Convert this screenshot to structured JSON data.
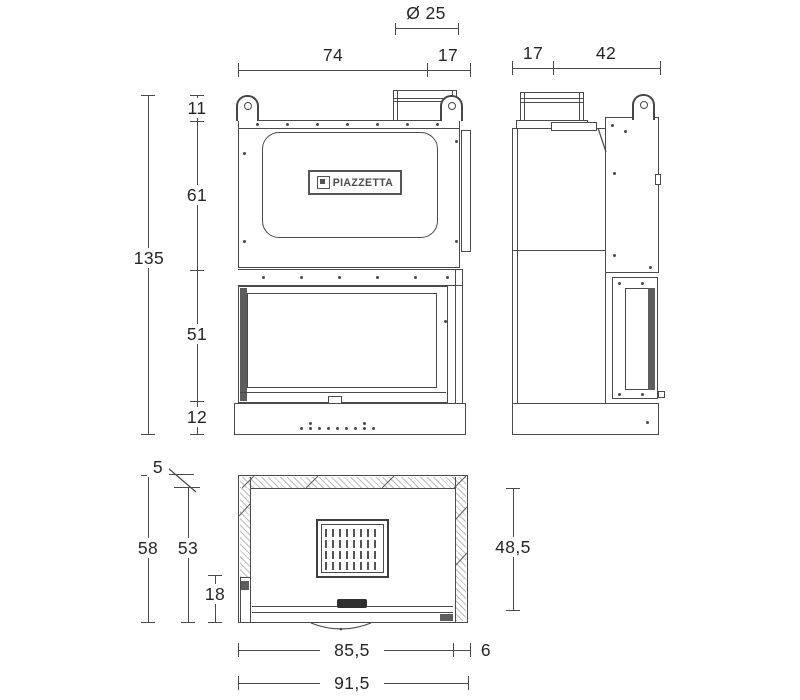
{
  "logo": {
    "text": "PIAZZETTA"
  },
  "front_view": {
    "dims": {
      "flue_diameter": "Ø 25",
      "body_width": "74",
      "side_extension": "17",
      "hook_height": "11",
      "hood_height": "61",
      "overall_height": "135",
      "door_height": "51",
      "base_height": "12"
    }
  },
  "side_view": {
    "dims": {
      "front_depth": "17",
      "rear_depth": "42"
    }
  },
  "plan_view": {
    "dims": {
      "wall_thickness": "5",
      "overall_depth": "58",
      "inner_depth": "53",
      "front_section_depth": "18",
      "glass_side_depth": "48,5",
      "inner_width": "85,5",
      "side_wall": "6",
      "overall_width": "91,5"
    }
  }
}
